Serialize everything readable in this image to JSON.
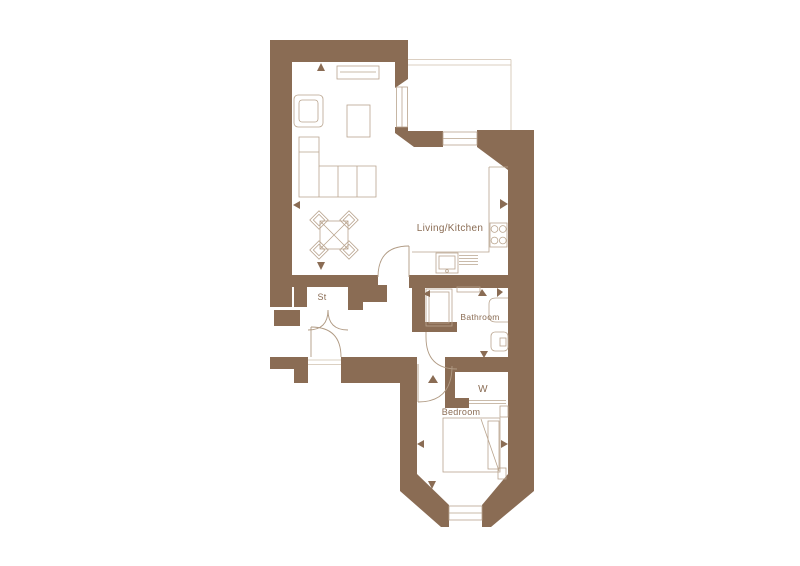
{
  "floorplan": {
    "type": "apartment-floor-plan",
    "colors": {
      "wall": "#8a6c54",
      "line": "#b9a48e",
      "door": "#b09a83",
      "threshold": "#cfc0ae",
      "text": "#8a6c54",
      "background": "#ffffff"
    },
    "rooms": {
      "living_kitchen": {
        "label": "Living/Kitchen"
      },
      "bathroom": {
        "label": "Bathroom"
      },
      "bedroom": {
        "label": "Bedroom"
      },
      "storage": {
        "label": "St"
      },
      "wardrobe": {
        "label": "W"
      }
    },
    "windows": 3,
    "doors": [
      "entrance",
      "living",
      "storage-double",
      "bathroom",
      "bedroom"
    ],
    "furniture": [
      "sofa",
      "armchair",
      "coffee-table",
      "tv-unit",
      "dining-table",
      "dining-chairs",
      "kitchen-counter",
      "hob",
      "sink",
      "shower",
      "basin",
      "toilet",
      "radiator",
      "wardrobe",
      "bed",
      "nightstands"
    ]
  }
}
